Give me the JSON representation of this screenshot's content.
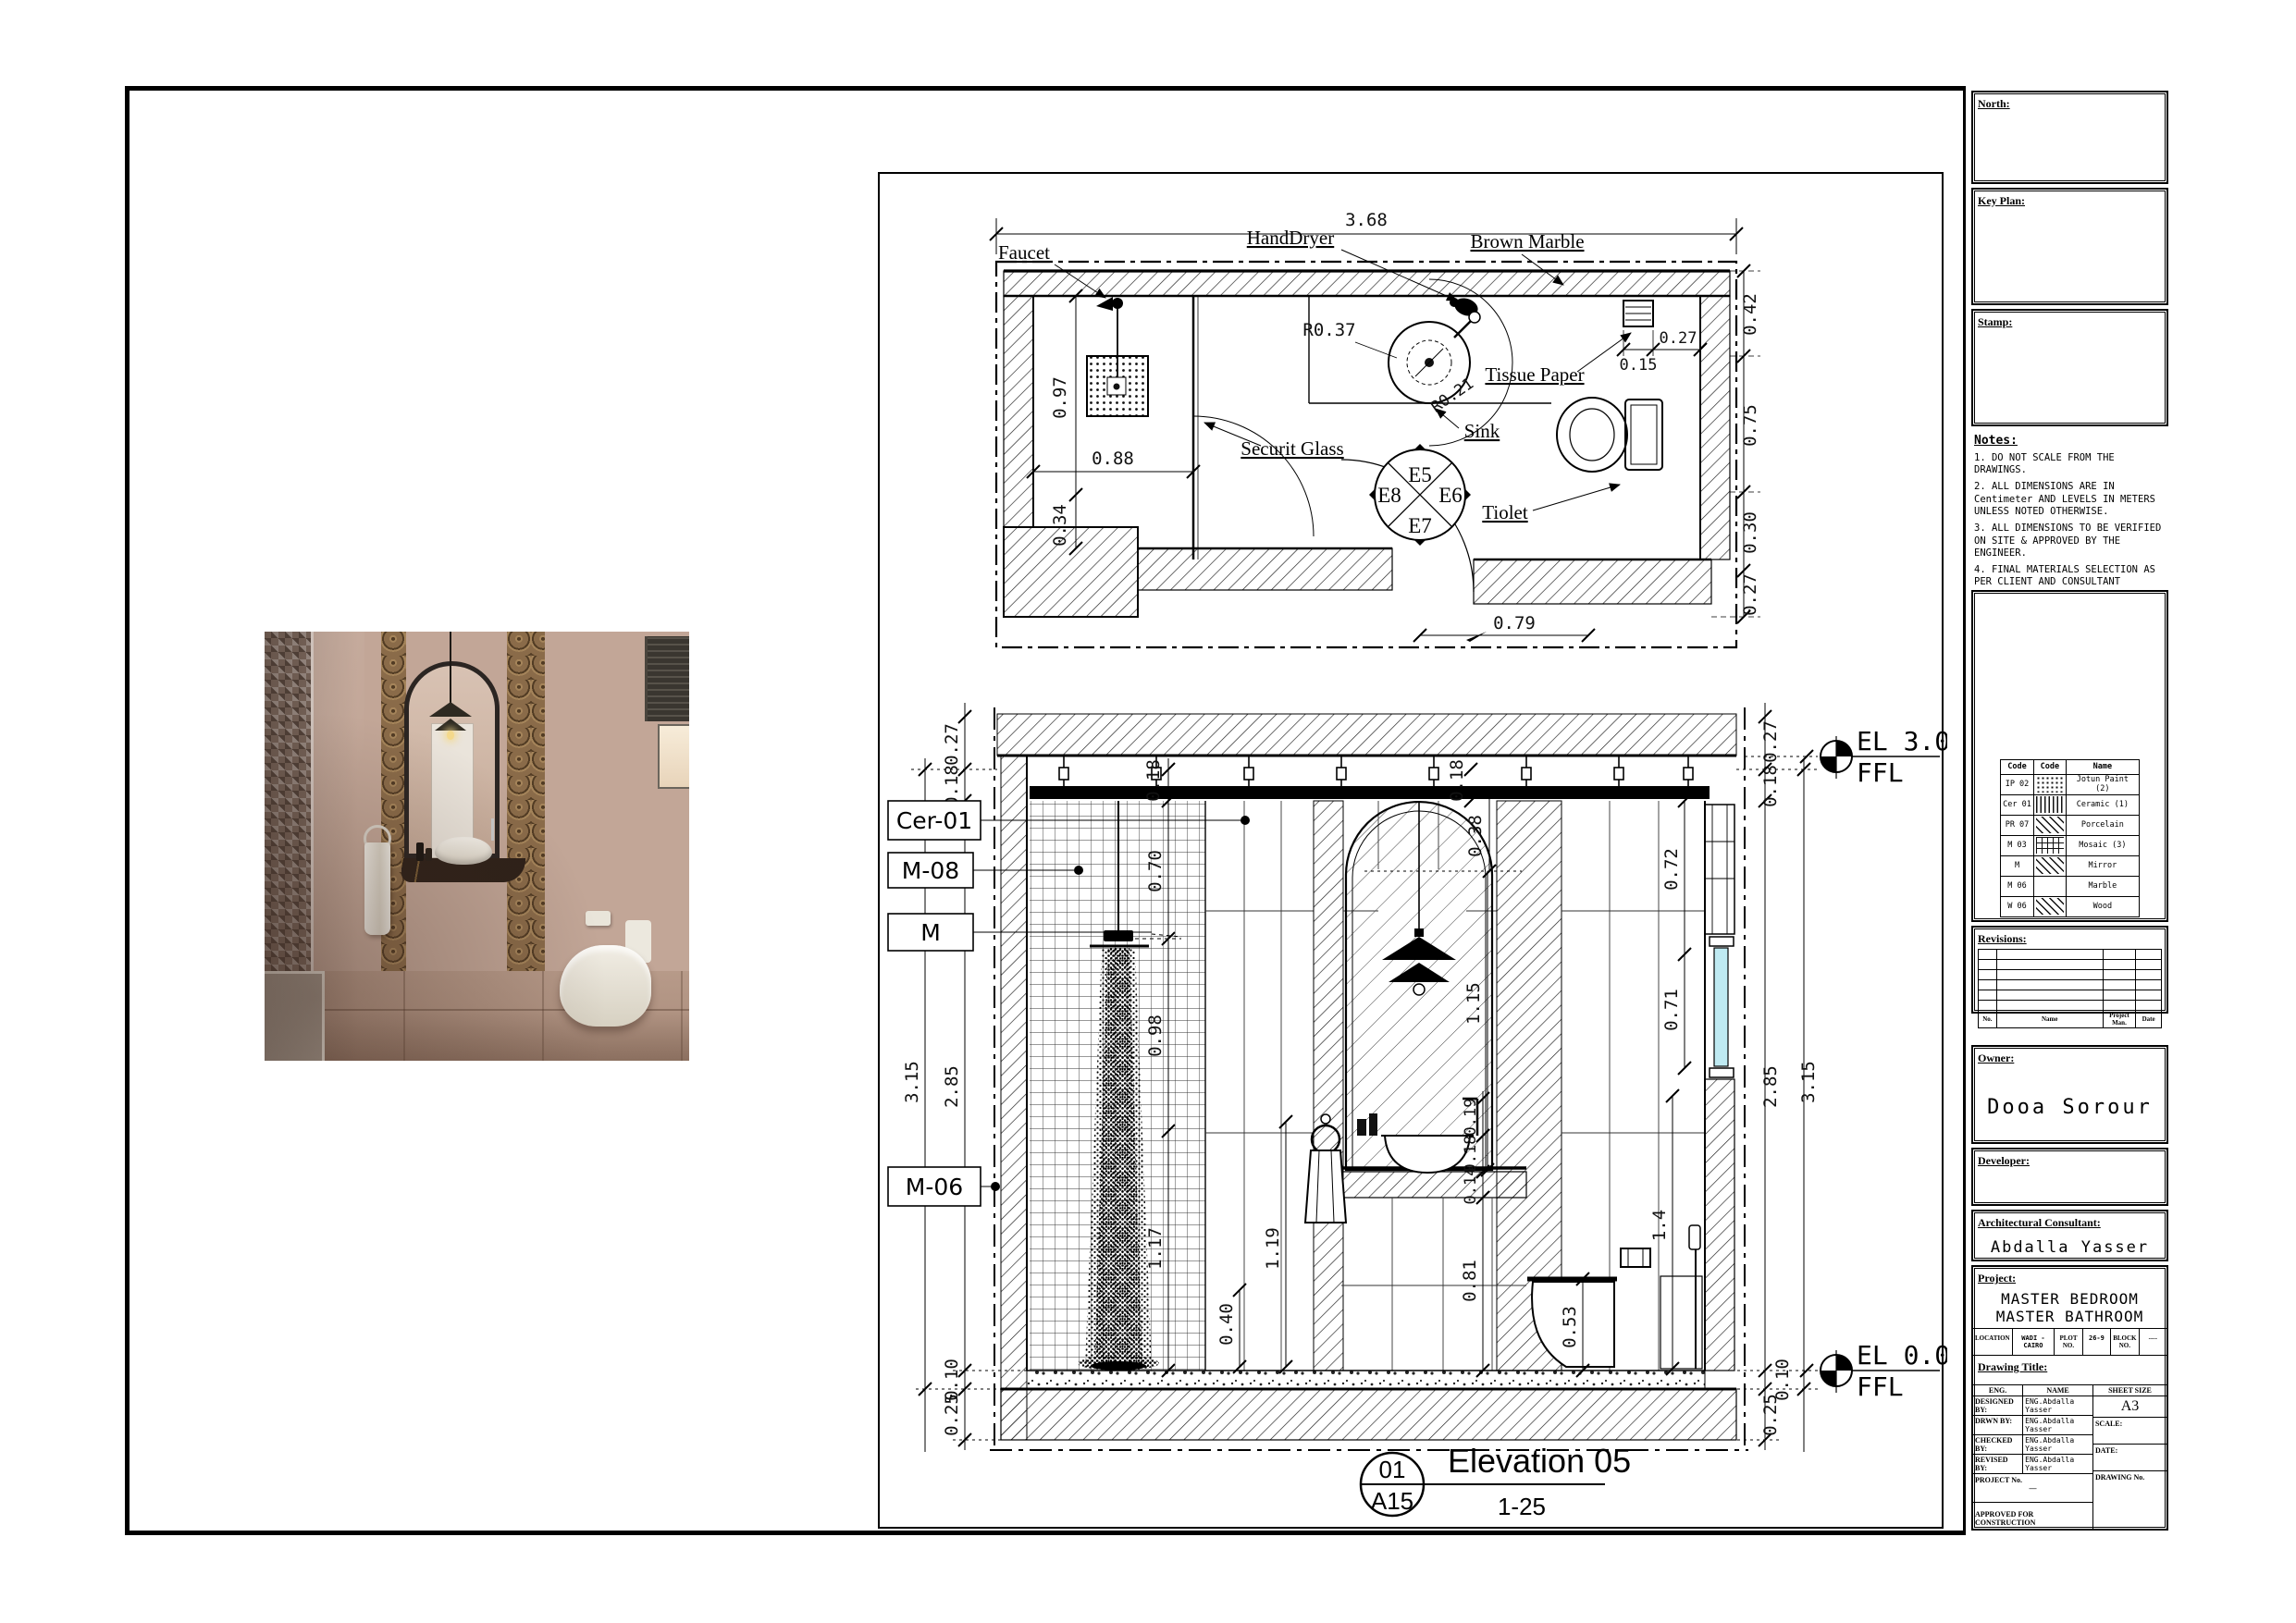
{
  "plan": {
    "labels": {
      "faucet": "Faucet",
      "hand_dryer": "HandDryer",
      "brown_marble": "Brown Marble",
      "tissue_paper": "Tissue Paper",
      "securit_glass": "Securit Glass",
      "sink": "Sink",
      "toilet": "Tiolet"
    },
    "dims": {
      "total_width": "3.68",
      "shower_depth": "0.97",
      "shower_width": "0.88",
      "left_lower": "0.34",
      "tp_to_wall": "0.27",
      "tp_width": "0.15",
      "right_top": "0.42",
      "right_mid": "0.75",
      "right_low": "0.30",
      "right_bottom": "0.27",
      "bottom": "0.79",
      "sink_radius": "R0.37",
      "sink_radius2": "R0.21"
    },
    "elev_marker": {
      "top": "E5",
      "right": "E6",
      "bottom": "E7",
      "left": "E8"
    }
  },
  "elevation": {
    "tags": {
      "t1": "Cer-01",
      "t2": "M-08",
      "t3": "M",
      "t4": "M-06"
    },
    "levels": {
      "top": "EL 3.05",
      "top_ref": "FFL",
      "bottom": "EL 0.00",
      "bottom_ref": "FFL"
    },
    "dims": {
      "l027": "0.27",
      "l018": "0.18",
      "l315": "3.15",
      "l285": "2.85",
      "l010": "0.10",
      "l025": "0.25",
      "r027": "0.27",
      "r018": "0.18",
      "r315": "3.15",
      "r285": "2.85",
      "r010": "0.10",
      "r025": "0.25",
      "r072": "0.72",
      "r071": "0.71",
      "i018a": "0.18",
      "i018b": "0.18",
      "i070": "0.70",
      "i098": "0.98",
      "i117": "1.17",
      "i038": "0.38",
      "i115": "1.15",
      "i119": "1.19",
      "i040": "0.40",
      "i081": "0.81",
      "i019": "0.19",
      "i018c": "0.18",
      "i014": "0.14",
      "i053": "0.53",
      "i140": "1.4"
    },
    "title": {
      "number": "01",
      "sheet": "A15",
      "name": "Elevation 05",
      "scale": "1-25"
    }
  },
  "titleblock": {
    "north_label": "North:",
    "keyplan_label": "Key Plan:",
    "stamp_label": "Stamp:",
    "notes_label": "Notes:",
    "notes": [
      "1. DO NOT SCALE FROM THE DRAWINGS.",
      "2. ALL DIMENSIONS ARE IN Centimeter AND LEVELS IN METERS UNLESS NOTED OTHERWISE.",
      "3. ALL DIMENSIONS TO BE VERIFIED ON SITE & APPROVED BY THE ENGINEER.",
      "4. FINAL MATERIALS SELECTION AS PER CLIENT AND CONSULTANT APPROVAL."
    ],
    "legend": {
      "headers": [
        "Code",
        "Code",
        "Name"
      ],
      "rows": [
        {
          "code": "IP 02",
          "swatch": "dots",
          "name": "Jotun Paint (2)"
        },
        {
          "code": "Cer 01",
          "swatch": "vlines",
          "name": "Ceramic (1)"
        },
        {
          "code": "PR 07",
          "swatch": "diag",
          "name": "Porcelain"
        },
        {
          "code": "M 03",
          "swatch": "grid",
          "name": "Mosaic (3)"
        },
        {
          "code": "M",
          "swatch": "diag",
          "name": "Mirror"
        },
        {
          "code": "M 06",
          "swatch": "blank",
          "name": "Marble"
        },
        {
          "code": "W 06",
          "swatch": "diag",
          "name": "Wood"
        }
      ]
    },
    "revisions_label": "Revisions:",
    "revisions_footer": [
      "No.",
      "Name",
      "Project Man.",
      "Date"
    ],
    "owner_label": "Owner:",
    "owner": "Dooa Sorour",
    "developer_label": "Developer:",
    "consultant_label": "Architectural Consultant:",
    "consultant": "Abdalla Yasser",
    "project_label": "Project:",
    "project_line1": "MASTER BEDROOM",
    "project_line2": "MASTER BATHROOM",
    "meta": {
      "location_label": "LOCATION",
      "location": "WADI - CAIRO",
      "plot_label": "PLOT NO.",
      "plot": "26-9",
      "block_label": "BLOCK NO.",
      "block": "----"
    },
    "drawing_title_label": "Drawing Title:",
    "eng": {
      "col_eng": "ENG.",
      "col_name": "NAME",
      "rows": [
        {
          "label": "DESIGNED BY:",
          "name": "ENG.Abdalla Yasser"
        },
        {
          "label": "DRWN BY:",
          "name": "ENG.Abdalla Yasser"
        },
        {
          "label": "CHECKED BY:",
          "name": "ENG.Abdalla Yasser"
        },
        {
          "label": "REVISED BY:",
          "name": "ENG.Abdalla Yasser"
        }
      ],
      "sheet_size_label": "SHEET SIZE",
      "sheet_size": "A3",
      "scale_label": "SCALE:",
      "project_no_label": "PROJECT No.",
      "project_no": "—",
      "date_label": "DATE:",
      "approved": "APPROVED FOR CONSTRUCTION",
      "drawing_no_label": "DRAWING No."
    }
  }
}
